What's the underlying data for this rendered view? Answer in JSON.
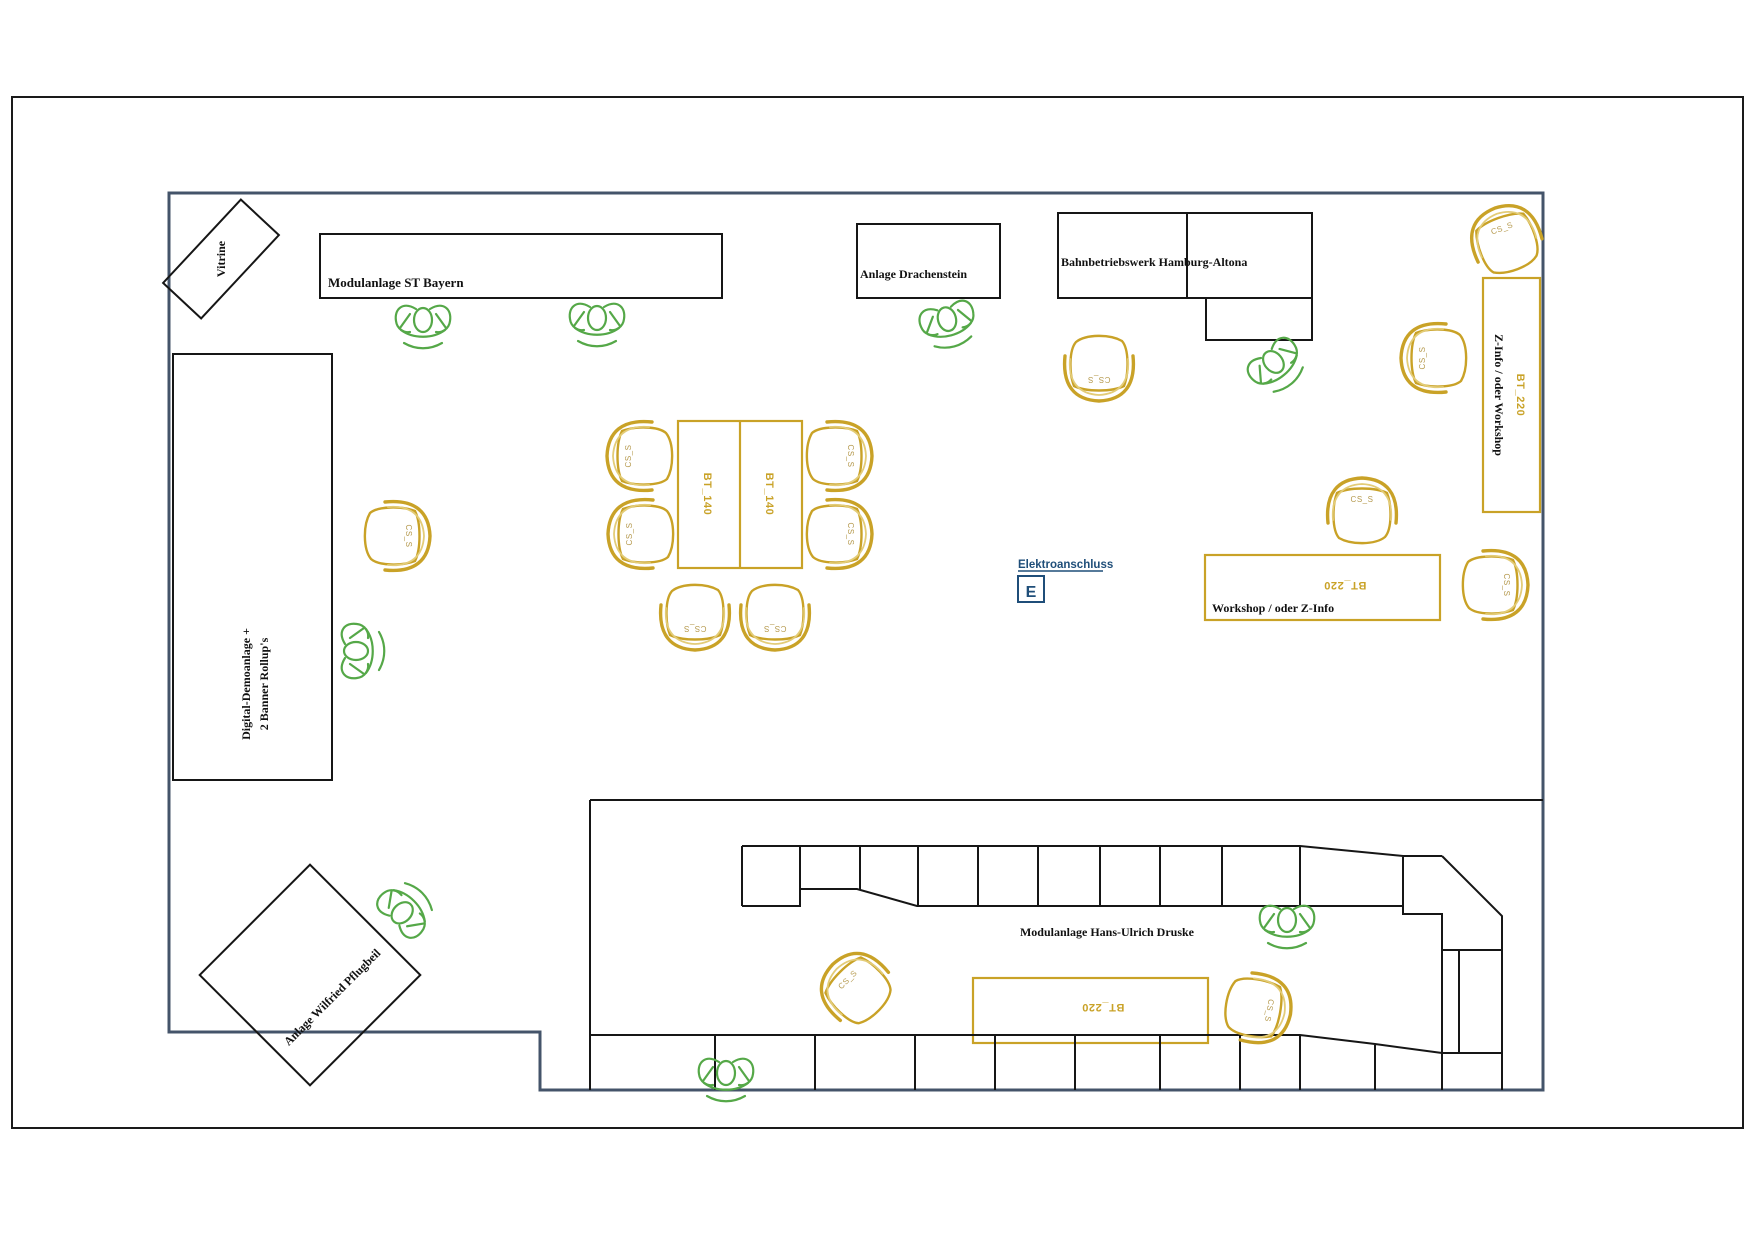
{
  "drawing": {
    "type": "exhibition-room-floor-plan"
  },
  "colors": {
    "wall": "#44546A",
    "structure": "#161616",
    "table": "#C9A227",
    "chair": "#C9A227",
    "chairAccent": "#E3CC78",
    "person": "#55A848",
    "electric": "#1F4E79",
    "chairText": "#B5994D"
  },
  "areas": {
    "vitrine": "Vitrine",
    "st_bayern": "Modulanlage ST Bayern",
    "drachenstein": "Anlage Drachenstein",
    "bahnbetriebswerk": "Bahnbetriebswerk Hamburg-Altona",
    "z_info_workshop": "Z-Info / oder Workshop",
    "workshop_z_info": "Workshop / oder Z-Info",
    "digital_demo_line1": "Digital-Demoanlage +",
    "digital_demo_line2": "2 Banner Rollup's",
    "pflugbeil": "Anlage Wilfried Pflugbeil",
    "druske": "Modulanlage Hans-Ulrich Druske"
  },
  "furniture": {
    "table_140": "BT_140",
    "table_220": "BT_220",
    "chair_label": "CS_S"
  },
  "electrical": {
    "label": "Elektroanschluss",
    "symbol": "E"
  }
}
